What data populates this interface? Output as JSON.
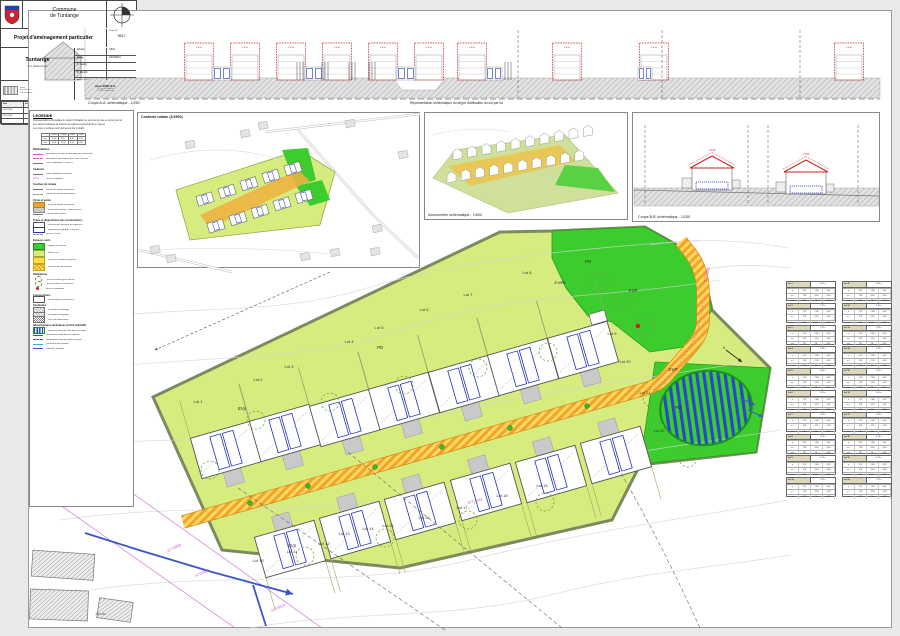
{
  "palette": {
    "chartreuse": "#d7ec7e",
    "green": "#3ccc2e",
    "road-orange": "#f2a32c",
    "road-yellow": "#ffd95e",
    "blue": "#2233bb",
    "magenta": "#cc55cc",
    "red": "#cc2222",
    "beige": "#ddd8bc",
    "parcel-border": "#7c8a60"
  },
  "captions": {
    "coupe_aa": "Coupe A-A' schématique - 1/250",
    "representation": "Représentation schématique du degré d'utilisation du sol par lot",
    "contexte": "Contexte urbain (1/2500)",
    "axono": "Axonométrie schématique - 1/500",
    "coupe_bb": "Coupe B-B' schématique - 1/250"
  },
  "legend": {
    "title": "LEGENDE",
    "intro": [
      "Représentation schématique du degré d'utilisation du sol et de la mise en œuvre par lot.",
      "Les valeurs indiquées se réfèrent au règlement grand-ducal en vigueur.",
      "Les cotes et surfaces sont données à titre indicatif."
    ],
    "table_rows": [
      [
        "",
        "L max",
        "P max",
        "H faît.",
        "CUS"
      ],
      [
        "min.",
        "12,00",
        "9,50",
        "6,50",
        "0,35"
      ],
      [
        "max.",
        "16,00",
        "12,00",
        "8,50",
        "0,60"
      ]
    ],
    "sections": [
      {
        "title": "Délimitations",
        "rows": [
          {
            "sym": "ln-mag",
            "text": "délimitation du plan d'aménagement particulier"
          },
          {
            "sym": "ln-mag-d",
            "text": "délimitation des différentes zones du PAG"
          },
          {
            "sym": "ln-gray",
            "text": "zone d'habitation 1 [HAB-1]"
          }
        ]
      },
      {
        "title": "Cadastre",
        "rows": [
          {
            "sym": "ln-gray",
            "text": "limite cadastrale existante"
          },
          {
            "sym": "txt-mag",
            "symtext": "677/1",
            "text": "numéro cadastral"
          }
        ]
      },
      {
        "title": "Courbes de niveau",
        "rows": [
          {
            "sym": "ln-gray",
            "text": "courbe de niveau maîtresse"
          },
          {
            "sym": "ln-gray-d",
            "text": "courbe de niveau secondaire"
          }
        ]
      },
      {
        "title": "Voirie et accès",
        "rows": [
          {
            "sym": "bx-or",
            "text": "voirie de desserte projetée"
          },
          {
            "sym": "bx-gray",
            "text": "accès carrossable / stationnement"
          },
          {
            "sym": "ln-gray",
            "text": "cheminement piéton"
          }
        ]
      },
      {
        "title": "Types et dispositions des constructions",
        "rows": [
          {
            "sym": "bx-white",
            "text": "construction destinée au logement"
          },
          {
            "sym": "bx-blue",
            "text": "dépendance (garage / car-port)"
          },
          {
            "sym": "ln-gray-d",
            "text": "recul sur limite"
          }
        ]
      },
      {
        "title": "Espaces verts",
        "swatch": true,
        "rows": [
          {
            "sym": "bx-green",
            "text": "espace vert public"
          },
          {
            "sym": "bx-chart",
            "text": "jardin privé"
          },
          {
            "sym": "bx-yellow",
            "text": "zone de circulation piétonne"
          },
          {
            "sym": "bx-yellow-h",
            "text": "accès privé carrossable"
          }
        ]
      },
      {
        "title": "Plantations",
        "rows": [
          {
            "sym": "ci-dash",
            "text": "arbre à haute tige à planter"
          },
          {
            "sym": "ci-dash",
            "text": "arbre existant à conserver"
          },
          {
            "sym": "dot-red",
            "text": "arbre remarquable"
          }
        ]
      },
      {
        "title": "Constructions",
        "rows": [
          {
            "sym": "bx-white",
            "text": "bâti existant (à conserver)"
          }
        ]
      },
      {
        "title": "Servitudes",
        "rows": [
          {
            "sym": "bx-hatch",
            "text": "servitude de passage"
          },
          {
            "sym": "bx-hatch",
            "text": "servitude écologique"
          },
          {
            "sym": "bx-check",
            "text": "zone non aedificandi"
          }
        ]
      },
      {
        "title": "Infrastructures techniques (à titre indicatif)",
        "rows": [
          {
            "sym": "bx-blue-h",
            "text": "bassin de rétention des eaux pluviales"
          },
          {
            "sym": "ln-blue",
            "text": "canalisation eaux usées projetée"
          },
          {
            "sym": "ln-blue-d",
            "text": "canalisation eaux pluviales projetée"
          },
          {
            "sym": "ln-cyan",
            "text": "conduite d'eau potable"
          },
          {
            "sym": "ln-blue",
            "text": "collecteur existant"
          }
        ]
      }
    ]
  },
  "top_strip": {
    "roof_label": "≤ 8,50",
    "houses": [
      199,
      245,
      291,
      337,
      383,
      429,
      472,
      567,
      654,
      849
    ],
    "connectors": [
      [
        213,
        231
      ],
      [
        305,
        323
      ],
      [
        397,
        415
      ],
      [
        486,
        502
      ],
      [
        638,
        652
      ]
    ],
    "dashed_lines": [
      518,
      662,
      800
    ],
    "ticks": [
      300,
      325,
      352,
      372,
      508
    ]
  },
  "coupe_bb": {
    "roof_label": "≤ 9,50",
    "houses": [
      [
        712,
        190
      ],
      [
        806,
        194
      ]
    ],
    "dashed_lines": [
      645,
      748,
      768,
      858
    ]
  },
  "main": {
    "houses_top": [
      [
        226,
        450
      ],
      [
        285,
        433
      ],
      [
        345,
        418
      ],
      [
        404,
        401
      ],
      [
        464,
        384
      ],
      [
        523,
        367
      ],
      [
        583,
        350
      ]
    ],
    "houses_bottom": [
      [
        290,
        549
      ],
      [
        355,
        530
      ],
      [
        420,
        511
      ],
      [
        486,
        492
      ],
      [
        551,
        474
      ],
      [
        616,
        455
      ]
    ],
    "trees": [
      [
        256,
        420
      ],
      [
        330,
        402
      ],
      [
        404,
        385
      ],
      [
        478,
        368
      ],
      [
        548,
        352
      ],
      [
        600,
        282
      ],
      [
        623,
        302
      ],
      [
        646,
        326
      ],
      [
        652,
        398
      ],
      [
        658,
        432
      ],
      [
        688,
        458
      ],
      [
        305,
        556
      ],
      [
        385,
        538
      ],
      [
        468,
        520
      ],
      [
        545,
        502
      ],
      [
        210,
        470
      ]
    ],
    "green_dots": [
      [
        250,
        503
      ],
      [
        308,
        486
      ],
      [
        375,
        467
      ],
      [
        442,
        447
      ],
      [
        510,
        428
      ],
      [
        587,
        406
      ]
    ],
    "labels": [
      {
        "t": "Lot 1",
        "x": 198,
        "y": 403
      },
      {
        "t": "Lot 2",
        "x": 258,
        "y": 381
      },
      {
        "t": "Lot 3",
        "x": 289,
        "y": 368
      },
      {
        "t": "Lot 4",
        "x": 349,
        "y": 343
      },
      {
        "t": "Lot 5",
        "x": 379,
        "y": 329
      },
      {
        "t": "Lot 6",
        "x": 424,
        "y": 311
      },
      {
        "t": "Lot 7",
        "x": 468,
        "y": 296
      },
      {
        "t": "Lot 8",
        "x": 527,
        "y": 274
      },
      {
        "t": "Lot 9",
        "x": 612,
        "y": 335
      },
      {
        "t": "Lot 10",
        "x": 258,
        "y": 562
      },
      {
        "t": "Lot 11",
        "x": 292,
        "y": 553
      },
      {
        "t": "Lot 12",
        "x": 324,
        "y": 545
      },
      {
        "t": "Lot 13",
        "x": 344,
        "y": 535
      },
      {
        "t": "Lot 14",
        "x": 368,
        "y": 530
      },
      {
        "t": "Lot 15",
        "x": 388,
        "y": 527
      },
      {
        "t": "Lot 16",
        "x": 424,
        "y": 519
      },
      {
        "t": "Lot 17",
        "x": 462,
        "y": 509
      },
      {
        "t": "Lot 18",
        "x": 502,
        "y": 497
      },
      {
        "t": "Lot 19",
        "x": 542,
        "y": 487
      },
      {
        "t": "Lot 20",
        "x": 625,
        "y": 363
      },
      {
        "t": "Lot 21",
        "x": 645,
        "y": 394
      },
      {
        "t": "Lot 22",
        "x": 659,
        "y": 432
      }
    ],
    "italic_labels": [
      {
        "t": "PD",
        "x": 588,
        "y": 263
      },
      {
        "t": "z-vert",
        "x": 560,
        "y": 284
      },
      {
        "t": "PD",
        "x": 678,
        "y": 409
      },
      {
        "t": "PD",
        "x": 380,
        "y": 349
      },
      {
        "t": "EVp",
        "x": 242,
        "y": 410
      },
      {
        "t": "EVp",
        "x": 292,
        "y": 547
      },
      {
        "t": "EVP",
        "x": 633,
        "y": 292
      },
      {
        "t": "EVP",
        "x": 673,
        "y": 371
      }
    ],
    "parcel_numbers": [
      {
        "t": "677/2889",
        "x": 168,
        "y": 552,
        "r": -25
      },
      {
        "t": "677/2892",
        "x": 196,
        "y": 577,
        "r": -25
      },
      {
        "t": "677/3910",
        "x": 272,
        "y": 612,
        "r": -25
      },
      {
        "t": "677/4180",
        "x": 468,
        "y": 504,
        "r": -14
      },
      {
        "t": "677/2885",
        "x": 706,
        "y": 282,
        "r": -75
      }
    ],
    "north_label": "K",
    "jardin_label": "Jardin",
    "red_dot": [
      638,
      326
    ]
  },
  "axono": {
    "house_path": "m0,0 l9,-1.8 l0,-6.5 l-4.5,-3 l-4.5,2.8 z",
    "rows": [
      {
        "x": 453,
        "y": 160,
        "dx": 14.5,
        "dy": -2.6,
        "n": 10
      },
      {
        "x": 447,
        "y": 183,
        "dx": 14.2,
        "dy": -2.4,
        "n": 10
      }
    ]
  },
  "contexte": {
    "rows": [
      {
        "x": 205,
        "y": 199,
        "dx": 22,
        "dy": -7.6,
        "n": 5
      },
      {
        "x": 216,
        "y": 226,
        "dx": 22,
        "dy": -7.4,
        "n": 5
      }
    ],
    "gray_houses": [
      [
        150,
        247
      ],
      [
        166,
        256
      ],
      [
        240,
        131
      ],
      [
        258,
        123
      ],
      [
        345,
        121
      ],
      [
        300,
        254
      ],
      [
        330,
        250
      ],
      [
        370,
        249
      ],
      [
        398,
        152
      ],
      [
        185,
        142
      ],
      [
        372,
        226
      ]
    ]
  },
  "tables": {
    "unit_label": "ares",
    "cell_rows": [
      [
        "a",
        "2,97",
        "CUS",
        "0,45"
      ],
      [
        "s.c.",
        "178",
        "COS",
        "0,28"
      ],
      [
        "s.sc.",
        "89",
        "DL",
        "0,52"
      ]
    ],
    "lots": [
      {
        "label": "Lot 1",
        "area": "3,05 a"
      },
      {
        "label": "Lot 2",
        "area": "2,97 a"
      },
      {
        "label": "Lot 3",
        "area": "3,12 a"
      },
      {
        "label": "Lot 4",
        "area": "2,88 a"
      },
      {
        "label": "Lot 5",
        "area": "3,40 a"
      },
      {
        "label": "Lot 6",
        "area": "2,95 a"
      },
      {
        "label": "Lot 7",
        "area": "3,18 a"
      },
      {
        "label": "Lot 8",
        "area": "3,02 a"
      },
      {
        "label": "Lot 9",
        "area": "4,25 a"
      },
      {
        "label": "Lot 10",
        "area": "2,90 a"
      },
      {
        "label": "Lot 11",
        "area": "2,86 a"
      },
      {
        "label": "Lot 12",
        "area": "3,10 a"
      },
      {
        "label": "Lot 13",
        "area": "2,94 a"
      },
      {
        "label": "Lot 14",
        "area": "3,22 a"
      },
      {
        "label": "Lot 15",
        "area": "2,87 a"
      },
      {
        "label": "Lot 16",
        "area": "3,05 a"
      },
      {
        "label": "Lot 17",
        "area": "2,99 a"
      },
      {
        "label": "Lot 18",
        "area": "3,14 a"
      },
      {
        "label": "Lot 19",
        "area": "3,41 a"
      },
      {
        "label": "Lot 20",
        "area": "5,12 a"
      }
    ]
  },
  "titleblock": {
    "commune1": "Commune",
    "commune2": "de Tuntange",
    "project": "Projet d'aménagement particulier",
    "project_no_label": "Projet N°",
    "project_no": "9617",
    "name": "Tuntange",
    "subtitle": "\" Um Haldescheed \"",
    "info_rows": [
      [
        "Echelle",
        "1/500"
      ],
      [
        "Date",
        "14/07/2014"
      ],
      [
        "K. Jacoby",
        ""
      ],
      [
        "R. Mersch",
        ""
      ],
      [
        "Plan N° (rv)",
        "1"
      ]
    ],
    "logo_lines": [
      "atelier",
      "d'architecture",
      "et d'urbanisme"
    ],
    "firm": {
      "name": "Arco 2000 S.A.",
      "line1": "12, rue de l'Industrie",
      "line2": "L-7420 Luxembourg"
    },
    "revisions": {
      "headers": [
        "Date",
        "Ind",
        "Modif. par",
        "Vérif. par",
        "Modifications"
      ],
      "rows": [
        [
          "10.07.2014",
          "-",
          "AB",
          "MM",
          "Mise à jour suivant les remarques de la commune"
        ],
        [
          "14.07.2014",
          "1",
          "AB",
          "MM",
          "Mise à jour suivant l'avis de la cellule d'évaluation du 11.07.2014 / réf. 17812/23C"
        ]
      ]
    }
  }
}
